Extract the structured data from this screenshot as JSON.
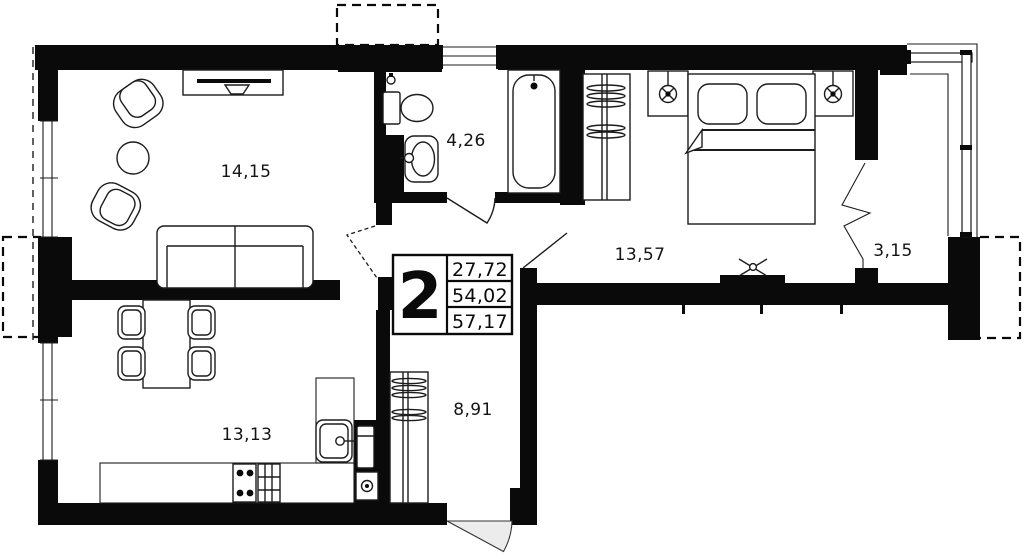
{
  "plan": {
    "rooms": [
      {
        "id": "living-room",
        "area": "14,15"
      },
      {
        "id": "bathroom",
        "area": "4,26"
      },
      {
        "id": "bedroom",
        "area": "13,57"
      },
      {
        "id": "balcony",
        "area": "3,15"
      },
      {
        "id": "kitchen",
        "area": "13,13"
      },
      {
        "id": "hallway",
        "area": "8,91"
      }
    ],
    "stamp": {
      "rooms_count": "2",
      "living_area": "27,72",
      "apartment_area": "54,02",
      "total_area": "57,17"
    },
    "colors": {
      "wall": "#0a0a0a",
      "line": "#1c1c1c",
      "background": "#ffffff",
      "door_swing_fill": "#ececec"
    }
  }
}
